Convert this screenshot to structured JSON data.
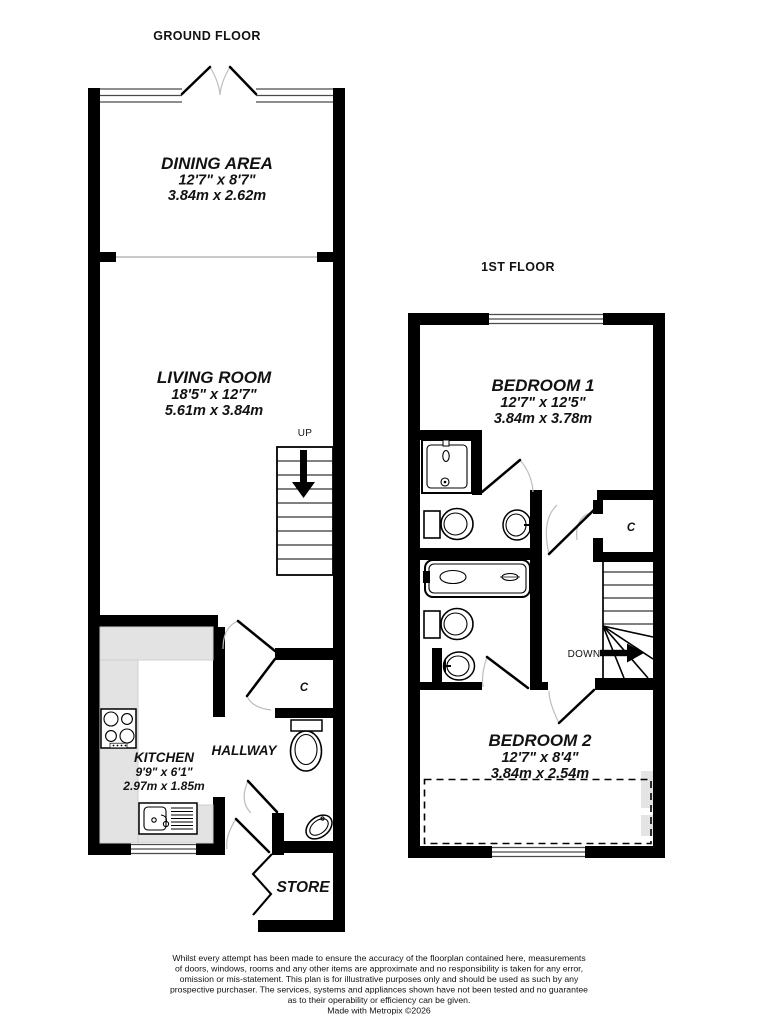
{
  "floors": {
    "ground": {
      "title": "GROUND FLOOR",
      "rooms": {
        "dining": {
          "name": "DINING AREA",
          "imperial": "12'7\" x 8'7\"",
          "metric": "3.84m x 2.62m"
        },
        "living": {
          "name": "LIVING ROOM",
          "imperial": "18'5\" x 12'7\"",
          "metric": "5.61m x 3.84m"
        },
        "kitchen": {
          "name": "KITCHEN",
          "imperial": "9'9\" x 6'1\"",
          "metric": "2.97m x 1.85m"
        },
        "hallway": {
          "name": "HALLWAY"
        },
        "cupboard": {
          "name": "C"
        },
        "store": {
          "name": "STORE"
        }
      },
      "stairs": {
        "label": "UP"
      }
    },
    "first": {
      "title": "1ST FLOOR",
      "rooms": {
        "bedroom1": {
          "name": "BEDROOM 1",
          "imperial": "12'7\" x 12'5\"",
          "metric": "3.84m x 3.78m"
        },
        "bedroom2": {
          "name": "BEDROOM 2",
          "imperial": "12'7\" x 8'4\"",
          "metric": "3.84m x 2.54m"
        },
        "cupboard": {
          "name": "C"
        }
      },
      "stairs": {
        "label": "DOWN"
      }
    }
  },
  "footer": {
    "lines": [
      "Whilst every attempt has been made to ensure the accuracy of the floorplan contained here, measurements",
      "of doors, windows, rooms and any other items are approximate and no responsibility is taken for any error,",
      "omission or mis-statement. This plan is for illustrative purposes only and should be used as such by any",
      "prospective purchaser. The services, systems and appliances shown have not been tested and no guarantee",
      "as to their operability or efficiency can be given.",
      "Made with Metropix ©2026"
    ]
  },
  "colors": {
    "wall": "#000000",
    "counter": "#e3e3e3",
    "reduced_headroom_patch": "#e4e4e4",
    "door_arc": "#bdbdbd",
    "text": "#121212",
    "background": "#ffffff"
  }
}
